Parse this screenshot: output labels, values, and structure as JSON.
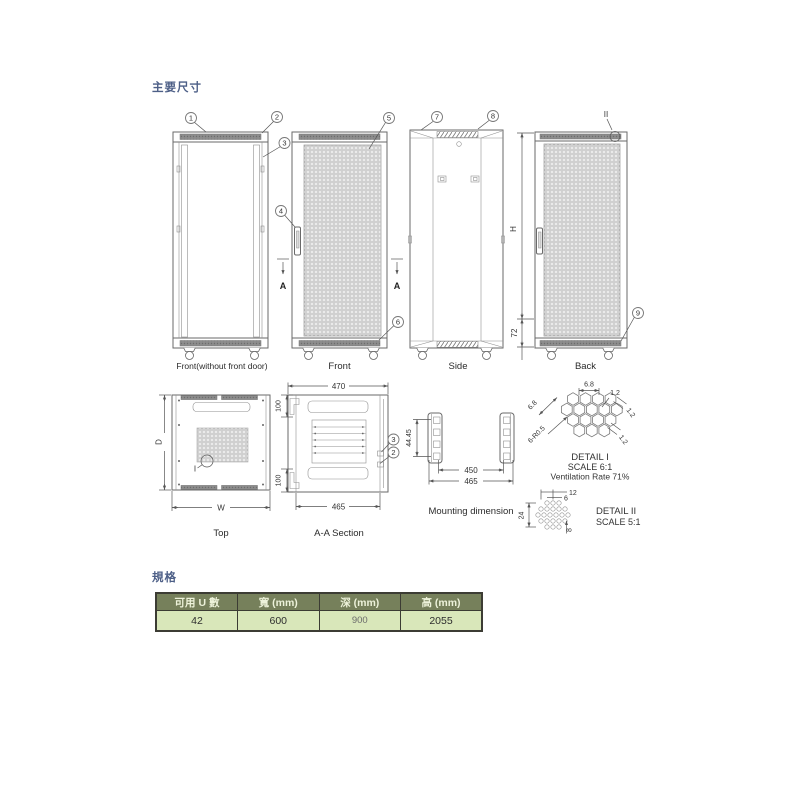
{
  "titles": {
    "main": "主要尺寸",
    "specs": "規格"
  },
  "view_labels": {
    "front_open": "Front(without front door)",
    "front": "Front",
    "side": "Side",
    "back": "Back",
    "top": "Top",
    "aa": "A-A Section",
    "mounting": "Mounting dimension"
  },
  "callouts": {
    "n1": "1",
    "n2": "2",
    "n3": "3",
    "n4": "4",
    "n5": "5",
    "n6": "6",
    "n7": "7",
    "n8": "8",
    "n9": "9",
    "aa3": "3",
    "aa2": "2",
    "detail1_ref": "I",
    "detail2_ref": "II"
  },
  "section_cut": {
    "left": "A",
    "right": "A"
  },
  "dimensions": {
    "back_height": "H",
    "back_plinth": "72",
    "top_depth": "D",
    "top_width": "W",
    "aa_top_width": "470",
    "aa_bottom_width": "465",
    "aa_upper_offset": "100",
    "aa_lower_offset": "100",
    "mount_unit_pitch": "44.45",
    "mount_hole_span": "450",
    "mount_rail_span": "465",
    "d1_hex_width": "6.8",
    "d1_hex_diag": "6.8",
    "d1_corner_radius": "6-R0.5",
    "d1_web_top": "1.2",
    "d1_web_right": "1.2",
    "d1_web_bottom": "1.2",
    "d2_pitch_double": "12",
    "d2_pitch": "6",
    "d2_col_height": "24",
    "d2_row_offset": "8"
  },
  "detail1": {
    "title": "DETAIL I",
    "scale": "SCALE 6:1",
    "ventilation": "Ventilation Rate 71%"
  },
  "detail2": {
    "title": "DETAIL II",
    "scale": "SCALE 5:1"
  },
  "spec_table": {
    "headers": [
      "可用 U 數",
      "寬 (mm)",
      "深 (mm)",
      "高 (mm)"
    ],
    "values": [
      "42",
      "600",
      "900",
      "2055"
    ]
  },
  "colors": {
    "title_text": "#4D5F87",
    "table_header_bg": "#76805B",
    "table_header_text": "#EDF2DA",
    "table_row_bg": "#D9E7BA",
    "table_border": "#3C3C34",
    "drawing_line": "#6A6A6A"
  }
}
